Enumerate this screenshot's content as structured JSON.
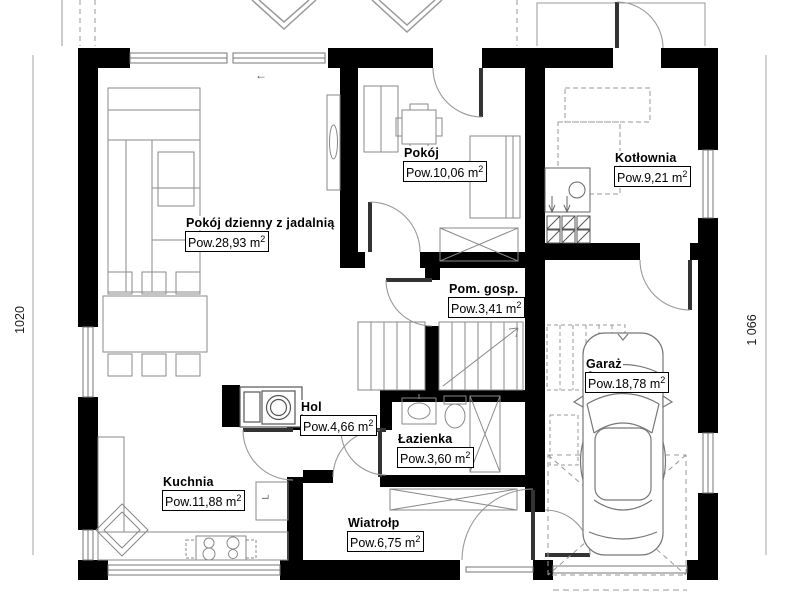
{
  "plan": {
    "rooms": [
      {
        "name": "Pokój dzienny z jadalnią",
        "area_prefix": "Pow.28,93 m",
        "area_sup": "2"
      },
      {
        "name": "Pokój",
        "area_prefix": "Pow.10,06 m",
        "area_sup": "2"
      },
      {
        "name": "Kotłownia",
        "area_prefix": "Pow.9,21 m",
        "area_sup": "2"
      },
      {
        "name": "Pom. gosp.",
        "area_prefix": "Pow.3,41 m",
        "area_sup": "2"
      },
      {
        "name": "Garaż",
        "area_prefix": "Pow.18,78 m",
        "area_sup": "2"
      },
      {
        "name": "Hol",
        "area_prefix": "Pow.4,66 m",
        "area_sup": "2"
      },
      {
        "name": "Łazienka",
        "area_prefix": "Pow.3,60 m",
        "area_sup": "2"
      },
      {
        "name": "Kuchnia",
        "area_prefix": "Pow.11,88 m",
        "area_sup": "2"
      },
      {
        "name": "Wiatrołp",
        "area_prefix": "Pow.6,75 m",
        "area_sup": "2"
      }
    ],
    "dimensions": {
      "left": "1020",
      "right": "1 066"
    },
    "symbols": {
      "slide_arrow": "←",
      "corner_cabinet": "L"
    },
    "colors": {
      "wall": "#000000",
      "line": "#777777",
      "background": "#ffffff"
    }
  }
}
